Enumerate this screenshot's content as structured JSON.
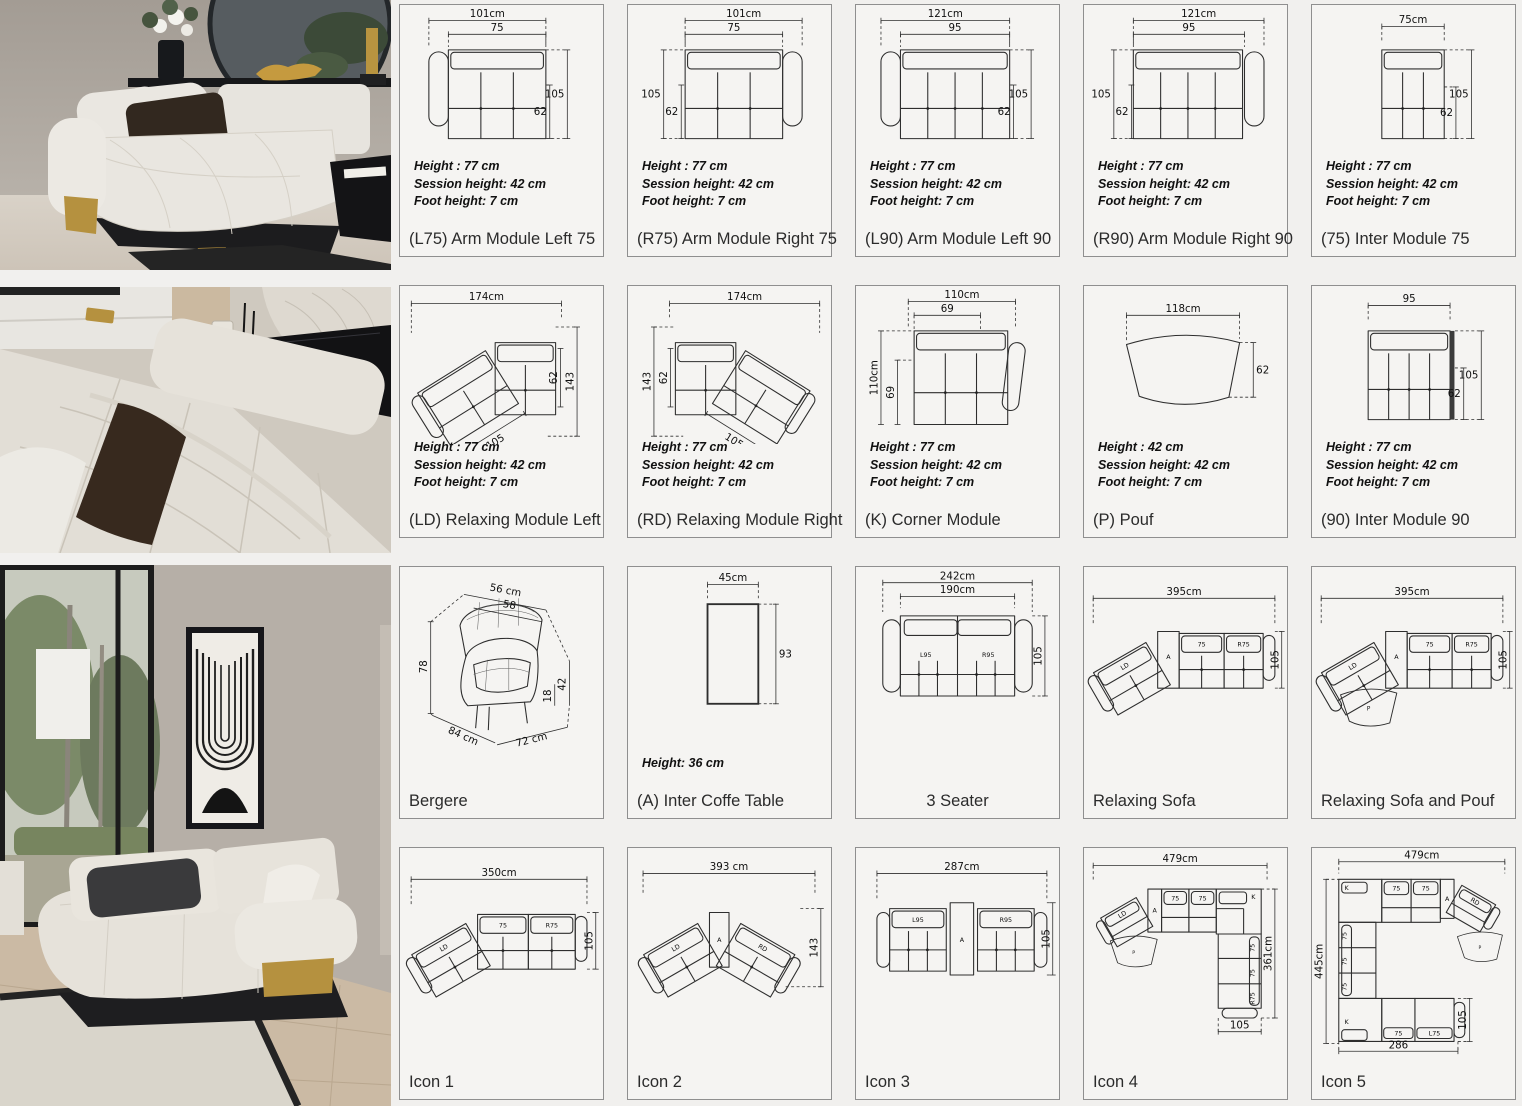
{
  "cards": [
    {
      "title": "(L75) Arm Module Left  75",
      "specs": [
        "Height  : 77 cm",
        "Session height: 42 cm",
        "Foot height: 7 cm"
      ],
      "dims": {
        "w": "101cm",
        "wi": "75",
        "h": "105",
        "hs": "62"
      }
    },
    {
      "title": "(R75)  Arm Module Right  75",
      "specs": [
        "Height  : 77 cm",
        "Session height: 42 cm",
        "Foot height: 7 cm"
      ],
      "dims": {
        "w": "101cm",
        "wi": "75",
        "h": "105",
        "hs": "62"
      }
    },
    {
      "title": "(L90) Arm Module Left  90",
      "specs": [
        "Height  : 77 cm",
        "Session height: 42 cm",
        "Foot height: 7 cm"
      ],
      "dims": {
        "w": "121cm",
        "wi": "95",
        "h": "105",
        "hs": "62"
      }
    },
    {
      "title": "(R90)  Arm Module Right  90",
      "specs": [
        "Height  : 77 cm",
        "Session height: 42 cm",
        "Foot height: 7 cm"
      ],
      "dims": {
        "w": "121cm",
        "wi": "95",
        "h": "105",
        "hs": "62"
      }
    },
    {
      "title": "(75) Inter Module 75",
      "specs": [
        "Height  : 77 cm",
        "Session height: 42 cm",
        "Foot height: 7 cm"
      ],
      "dims": {
        "w": "75cm",
        "h": "105",
        "hs": "62"
      }
    },
    {
      "title": "(LD) Relaxing Module Left",
      "specs": [
        "Height  : 77 cm",
        "Session height: 42 cm",
        "Foot height: 7 cm"
      ],
      "dims": {
        "w": "174cm",
        "h": "143",
        "hs": "62",
        "seat": "105"
      }
    },
    {
      "title": "(RD) Relaxing Module Right",
      "specs": [
        "Height  : 77 cm",
        "Session height: 42 cm",
        "Foot height: 7 cm"
      ],
      "dims": {
        "w": "174cm",
        "h": "143",
        "hs": "62",
        "seat": "105"
      }
    },
    {
      "title": "(K) Corner Module",
      "specs": [
        "Height  : 77 cm",
        "Session height: 42 cm",
        "Foot height: 7 cm"
      ],
      "dims": {
        "w": "110cm",
        "wi": "69",
        "h": "110cm",
        "hi": "69"
      }
    },
    {
      "title": "(P) Pouf",
      "specs": [
        "Height  : 42 cm",
        "Session height: 42 cm",
        "Foot height: 7 cm"
      ],
      "dims": {
        "w": "118cm",
        "h": "62"
      }
    },
    {
      "title": "(90) Inter Module  90",
      "specs": [
        "Height  : 77 cm",
        "Session height: 42 cm",
        "Foot height: 7 cm"
      ],
      "dims": {
        "w": "95",
        "h": "105",
        "hs": "62"
      }
    },
    {
      "title": "Bergere",
      "dims": {
        "top": "56 cm",
        "top2": "58",
        "h": "78",
        "depth": "84 cm",
        "w": "72 cm",
        "seat": "42",
        "leg": "18"
      }
    },
    {
      "title": "(A) Inter Coffe Table",
      "specs": [
        "Height: 36 cm"
      ],
      "dims": {
        "w": "45cm",
        "h": "93"
      }
    },
    {
      "title": "3 Seater",
      "dims": {
        "w": "242cm",
        "wi": "190cm",
        "h": "105"
      },
      "labels": [
        "L95",
        "R95"
      ]
    },
    {
      "title": "Relaxing Sofa",
      "dims": {
        "w": "395cm",
        "h": "105"
      },
      "labels": [
        "LD",
        "A",
        "75",
        "R75"
      ]
    },
    {
      "title": "Relaxing Sofa and Pouf",
      "dims": {
        "w": "395cm",
        "h": "105"
      },
      "labels": [
        "LD",
        "A",
        "75",
        "R75",
        "P"
      ]
    },
    {
      "title": "Icon 1",
      "dims": {
        "w": "350cm",
        "h": "105"
      },
      "labels": [
        "LD",
        "75",
        "R75"
      ]
    },
    {
      "title": "Icon 2",
      "dims": {
        "w": "393 cm",
        "h": "143"
      },
      "labels": [
        "LD",
        "A",
        "RD"
      ]
    },
    {
      "title": "Icon 3",
      "dims": {
        "w": "287cm",
        "h": "105"
      },
      "labels": [
        "L95",
        "A",
        "R95"
      ]
    },
    {
      "title": "Icon 4",
      "dims": {
        "w": "479cm",
        "h": "361cm",
        "d": "105"
      },
      "labels": [
        "LD",
        "A",
        "75",
        "75",
        "K",
        "75",
        "75",
        "R75",
        "P"
      ]
    },
    {
      "title": "Icon 5",
      "dims": {
        "w": "479cm",
        "h": "445cm",
        "d": "105",
        "w2": "286"
      },
      "labels": [
        "K",
        "75",
        "75",
        "A",
        "RD",
        "P",
        "75",
        "75",
        "75",
        "K",
        "75",
        "L75"
      ]
    }
  ]
}
